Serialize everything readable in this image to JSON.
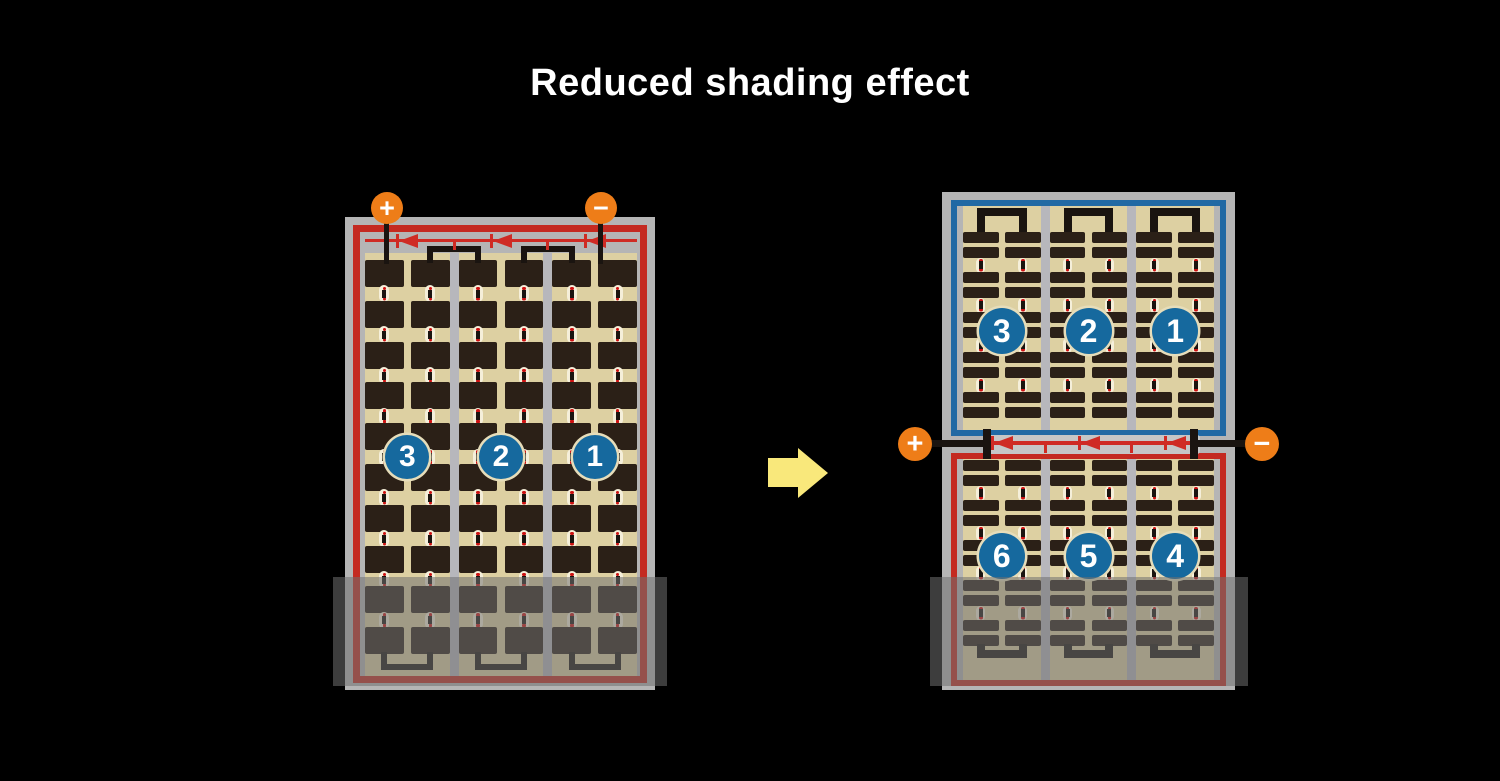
{
  "title": "Reduced shading effect",
  "colors": {
    "background": "#000000",
    "title_text": "#ffffff",
    "panel_frame": "#b5b5b5",
    "cell_background": "#ddd0a2",
    "cell_dark": "#2b2017",
    "outline_red": "#c42a21",
    "outline_blue": "#2169a4",
    "diode_red": "#cf2b24",
    "terminal_orange": "#ee7d18",
    "badge_blue": "#16699e",
    "badge_ring": "#e6ddba",
    "arrow_yellow": "#f9e87b",
    "shade": "rgba(112,112,112,0.55)",
    "divider": "#b7b7bc",
    "wire": "#1a1410",
    "connector_light": "#f5efda",
    "connector_dot": "#cc1111",
    "junction_band": "#c6c6c6"
  },
  "left_module": {
    "terminals": {
      "positive": "+",
      "negative": "−"
    },
    "string_numbers": [
      "3",
      "2",
      "1"
    ],
    "columns": 3,
    "cell_rows": 10,
    "bypass_diodes": 3,
    "shaded_bottom": true
  },
  "right_module": {
    "terminals": {
      "positive": "+",
      "negative": "−"
    },
    "columns": 3,
    "top_half": {
      "outline": "blue",
      "string_numbers": [
        "3",
        "2",
        "1"
      ],
      "cell_groups": 5
    },
    "bottom_half": {
      "outline": "red",
      "string_numbers": [
        "6",
        "5",
        "4"
      ],
      "cell_groups": 5
    },
    "bypass_diodes": 3,
    "shaded_bottom": true
  },
  "arrow": {
    "direction": "right"
  }
}
